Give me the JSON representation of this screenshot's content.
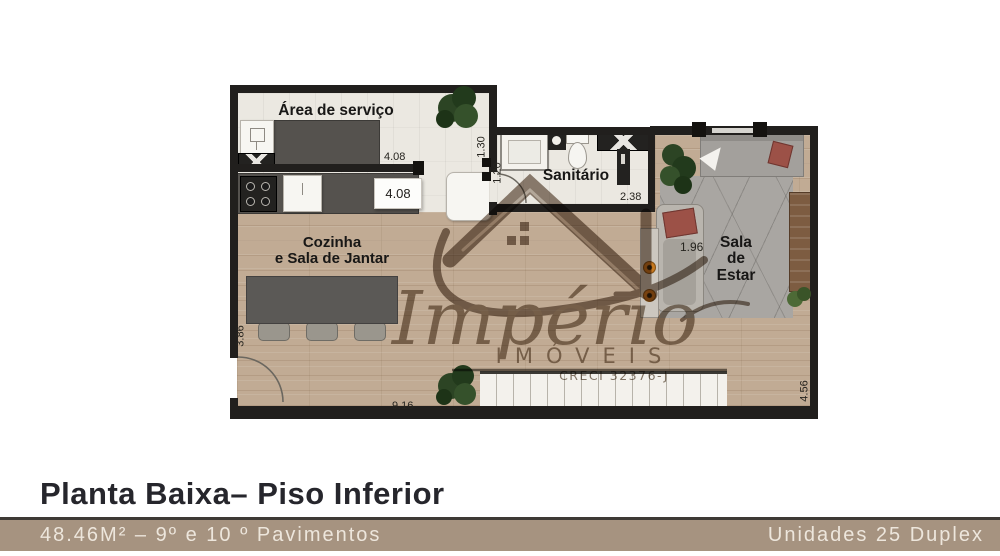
{
  "plan": {
    "rooms": {
      "area_servico": {
        "label": "Área de serviço"
      },
      "sanitario": {
        "label": "Sanitário"
      },
      "cozinha": {
        "label_line1": "Cozinha",
        "label_line2": "e Sala de Jantar"
      },
      "sala_estar": {
        "label_line1": "Sala",
        "label_line2": "de",
        "label_line3": "Estar"
      }
    },
    "dims": {
      "servico_top": "4.08",
      "kitchen": "4.08",
      "passage": "1.30",
      "sanit_left": "1.20",
      "sanit_bottom": "2.38",
      "sala": "1.96",
      "left_side": "3.86",
      "bottom": "9.16",
      "right_side": "4.56"
    }
  },
  "watermark": {
    "brand_script": "Império",
    "brand_caps": "IMÓVEIS",
    "creci": "CRECI 32376-J"
  },
  "footer": {
    "title": "Planta Baixa– Piso Inferior",
    "area_info": "48.46M² – 9º e 10 º Pavimentos",
    "units_info": "Unidades 25  Duplex"
  },
  "colors": {
    "wall": "#211f1d",
    "wood_floor": "#c1ab94",
    "cream_floor": "#ebe8e1",
    "footer_bar": "#a69380",
    "watermark": "#7a695a"
  }
}
